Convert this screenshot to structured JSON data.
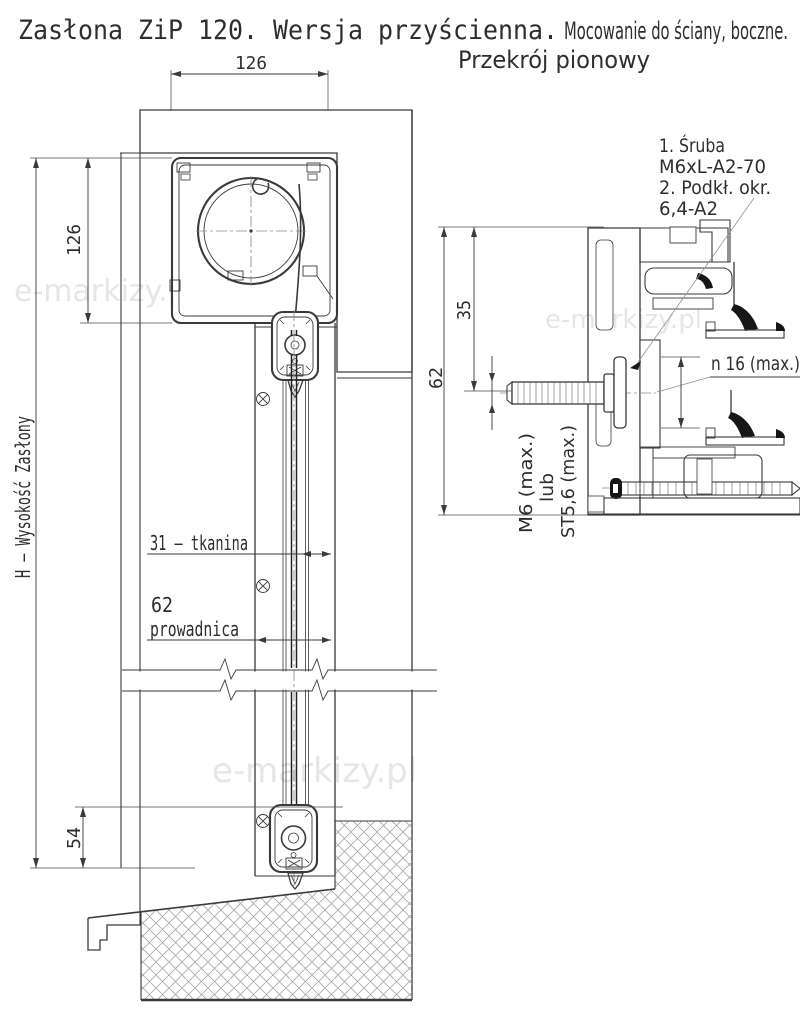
{
  "title": {
    "part1": "Zasłona ZiP 120. Wersja przyścienna.",
    "part2": "Mocowanie do ściany, boczne.",
    "subtitle": "Przekrój pionowy"
  },
  "main_view": {
    "dim_top_width": "126",
    "dim_cassette_height": "126",
    "dim_total_height": "H – Wysokość Zasłony",
    "dim_bottom_offset": "54",
    "dim_fabric": "31 – tkanina",
    "dim_guide_value": "62",
    "dim_guide_name": "prowadnica"
  },
  "detail_view": {
    "dim_depth": "62",
    "dim_axis_offset": "35",
    "note_line1": "1. Śruba",
    "note_line2": "M6xL-A2-70",
    "note_line3": "2. Podkł. okr.",
    "note_line4": "6,4-A2",
    "washer_diameter": "n 16 (max.)",
    "thread_line1": "M6 (max.)",
    "thread_line2": "lub",
    "thread_line3": "ST5,6 (max.)"
  },
  "watermark": {
    "text": "e-markizy.pl"
  },
  "colors": {
    "line": "#3a3a3a",
    "masonry_hatch": "#a8a8a8",
    "profile_hatch": "#666666",
    "watermark": "#e6e6e8",
    "background": "#ffffff"
  }
}
